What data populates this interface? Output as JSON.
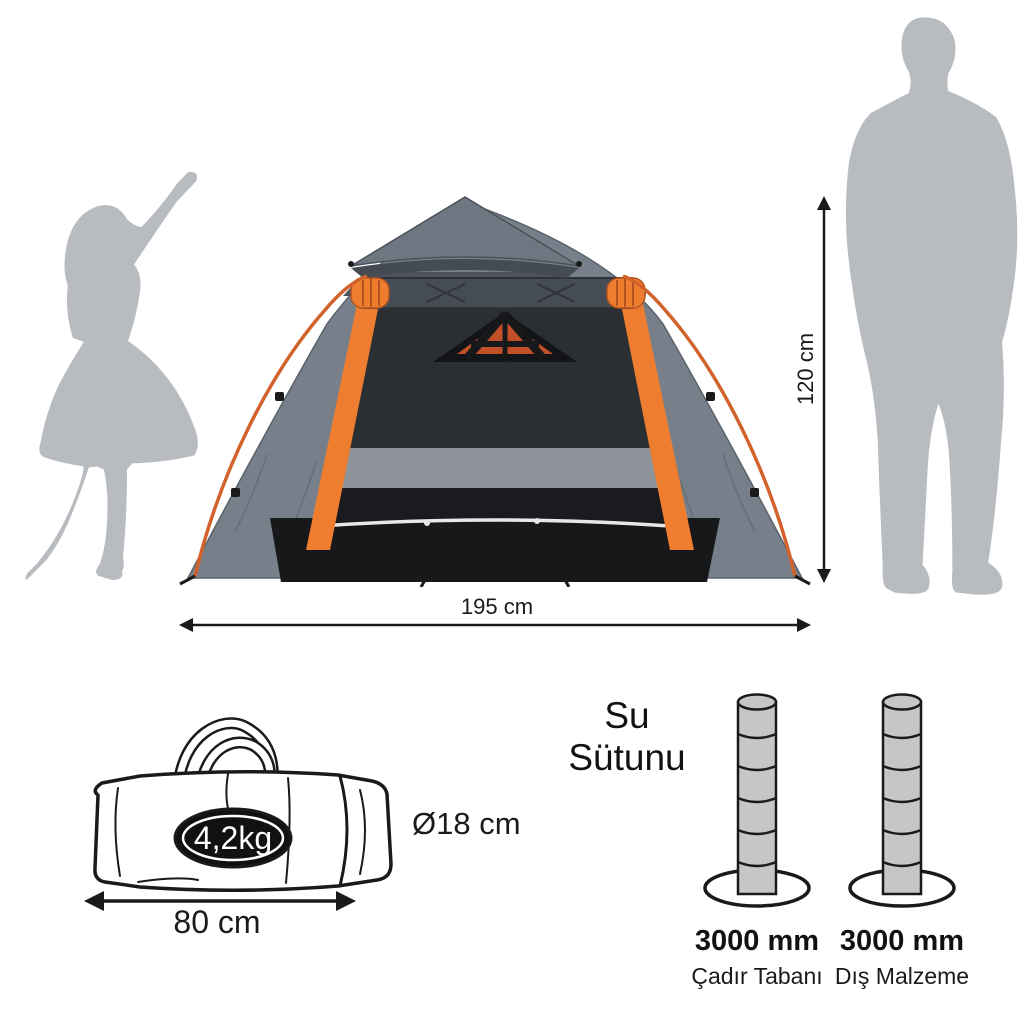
{
  "diagram": {
    "kind": "tent-product-spec-infographic",
    "background": "#ffffff",
    "text_color": "#1a1a1a"
  },
  "tent": {
    "height_label": "120 cm",
    "width_label": "195 cm",
    "colors": {
      "canopy_gray": "#77808a",
      "canopy_dark": "#4d545c",
      "roll_dark": "#454c54",
      "trim_orange": "#ee7d2f",
      "pole_orange": "#d2622c",
      "interior_mesh": "#2b2f33",
      "inner_band_gray": "#8d9399",
      "floor_black": "#17181a",
      "zipper_white": "#e8e8e8"
    }
  },
  "silhouettes": {
    "color": "#b8bcc0",
    "left_figure": "child-raising-arm",
    "right_figure": "standing-man"
  },
  "bag": {
    "weight_label": "4,2kg",
    "diameter_label": "Ø18 cm",
    "length_label": "80 cm",
    "badge_color": "#111111",
    "line_color": "#1a1a1a"
  },
  "water_column": {
    "heading": "Su Sütunu",
    "cylinder_color": "#c6c6c8",
    "columns": [
      {
        "value": "3000 mm",
        "caption": "Çadır Tabanı"
      },
      {
        "value": "3000 mm",
        "caption": "Dış Malzeme"
      }
    ]
  }
}
